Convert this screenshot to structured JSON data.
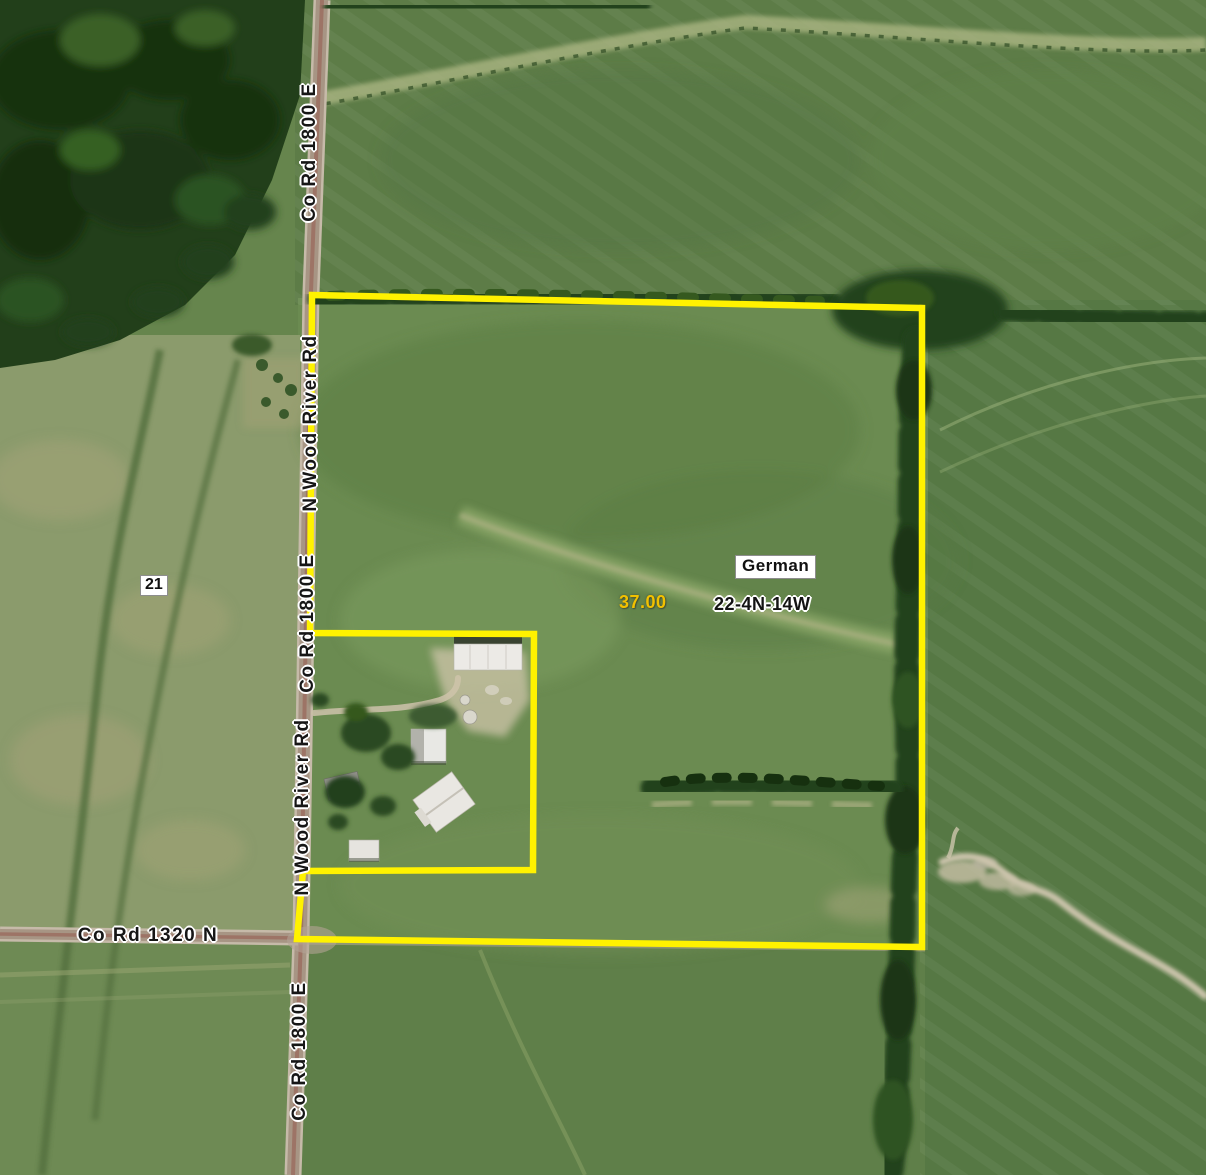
{
  "map": {
    "road_labels": [
      {
        "text": "Co Rd 1800 E",
        "orientation": "vertical"
      },
      {
        "text": "N Wood River Rd",
        "orientation": "vertical"
      },
      {
        "text": "Co Rd 1800 E",
        "orientation": "vertical"
      },
      {
        "text": "N Wood River Rd",
        "orientation": "vertical"
      },
      {
        "text": "Co Rd 1320 N",
        "orientation": "horizontal"
      },
      {
        "text": "Co Rd 1800 E",
        "orientation": "vertical"
      }
    ],
    "parcel": {
      "acreage_label": "37.00",
      "township_label": "German",
      "section_township_range_label": "22-4N-14W",
      "boundary_color": "#FFF200",
      "acreage_label_color": "#F2C100"
    },
    "adjacent_section_label": "21"
  }
}
